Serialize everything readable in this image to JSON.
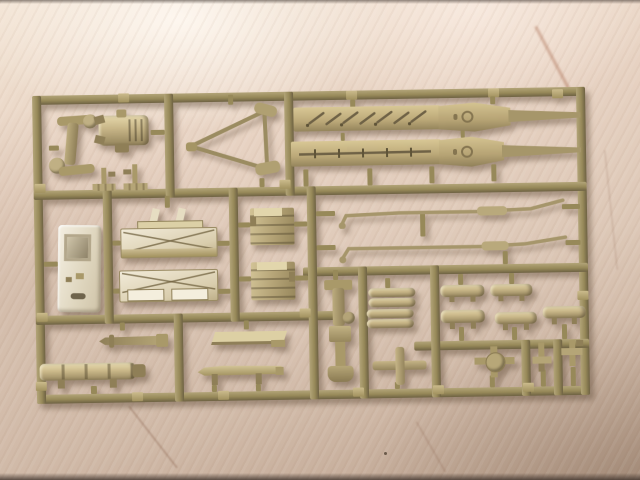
{
  "meta": {
    "type": "photograph",
    "description": "Tan injection-moulded plastic model-kit sprue (parts tree) lying on a light wooden table"
  },
  "colors": {
    "woodLight": "#f2e3d3",
    "woodMid": "#ddc8b7",
    "woodDark": "#c0a794",
    "frameHi": "#b2a478",
    "frame": "#978959",
    "frameLo": "#6e6243",
    "partHi": "#e8dcb4",
    "part": "#c3b283",
    "partLo": "#8c7c55",
    "whitePart": "#efe8d6",
    "shadowC": "rgba(90,70,50,0.45)"
  },
  "sprue": {
    "frame_name": "rectangular sprue frame with internal runners",
    "parts": {
      "axle": {
        "name": "Axle assembly with round hubs"
      },
      "engine": {
        "name": "Ribbed engine block"
      },
      "clamp1": {
        "name": "Small clamp part"
      },
      "clamp2": {
        "name": "Small clamp part"
      },
      "triangle": {
        "name": "Triangular tow bar"
      },
      "fenderUpper": {
        "name": "Long fender strip with pioneer tools and embossed ring mark"
      },
      "fenderLower": {
        "name": "Long fender strip with tool rod and embossed ring mark"
      },
      "door": {
        "name": "Cab door panel with window"
      },
      "bench": {
        "name": "Bracket strip with two angled lugs"
      },
      "box1": {
        "name": "Stowage box with X-pattern lid"
      },
      "box2": {
        "name": "Stowage box with X-pattern lid and two panels"
      },
      "block1": {
        "name": "Stepped hull block"
      },
      "block2": {
        "name": "Stepped hull block"
      },
      "rod1": {
        "name": "Bent tow rod with sleeve"
      },
      "rod2": {
        "name": "Bent tow rod with sleeve"
      },
      "mount": {
        "name": "Vertical mount assembly"
      },
      "drums1": {
        "name": "Paired drum cylinders"
      },
      "drums2": {
        "name": "Paired drum cylinders"
      },
      "cyl1": {
        "name": "Drum cylinder on stand"
      },
      "cyl2": {
        "name": "Drum cylinder on stand"
      },
      "cyl3": {
        "name": "Drum cylinder on stand"
      },
      "cyl4": {
        "name": "Drum cylinder on stand"
      },
      "cyl5": {
        "name": "Drum cylinder on stand"
      },
      "hub": {
        "name": "Wheel hub with cross arms"
      },
      "bracket1": {
        "name": "Small T-bracket"
      },
      "bracket2": {
        "name": "Small T-bracket"
      },
      "cross": {
        "name": "Cross-shaped part"
      },
      "barrel": {
        "name": "Tapered barrel rod"
      },
      "muffler": {
        "name": "Banded exhaust muffler"
      },
      "tray": {
        "name": "Flat tray part"
      },
      "skid": {
        "name": "Skid plate on legs"
      }
    }
  }
}
